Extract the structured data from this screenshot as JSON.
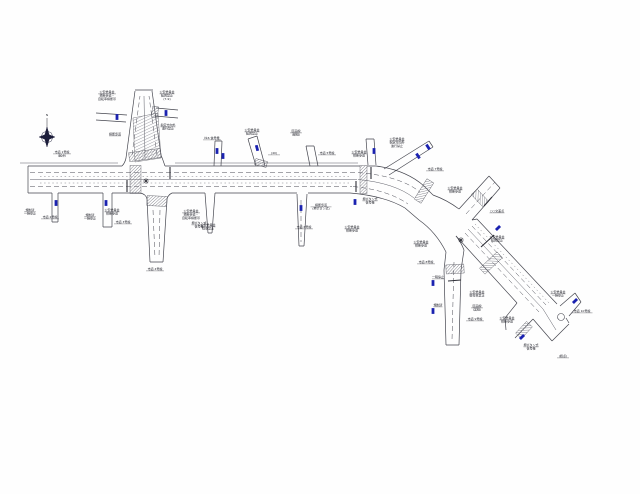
{
  "drawing": {
    "type": "road-traffic-regulation-plan",
    "colors": {
      "line": "#45464f",
      "sign_blue": "#1b22b0",
      "hatch": "#6f707a",
      "text": "#23242c",
      "background": "#fefefe"
    },
    "compass": {
      "x": 47,
      "y": 137,
      "label": "N"
    },
    "signals": [
      {
        "x": 146,
        "y": 181
      },
      {
        "x": 461,
        "y": 240
      }
    ],
    "signs": [
      {
        "x": 56,
        "y": 203,
        "a": 0
      },
      {
        "x": 106,
        "y": 203,
        "a": 0
      },
      {
        "x": 117,
        "y": 117,
        "a": 0
      },
      {
        "x": 166,
        "y": 113,
        "a": 0
      },
      {
        "x": 217,
        "y": 151,
        "a": 0
      },
      {
        "x": 223,
        "y": 156,
        "a": 0
      },
      {
        "x": 257,
        "y": 148,
        "a": -15
      },
      {
        "x": 301,
        "y": 208,
        "a": 0
      },
      {
        "x": 355,
        "y": 202,
        "a": 0
      },
      {
        "x": 374,
        "y": 151,
        "a": 0
      },
      {
        "x": 418,
        "y": 156,
        "a": -33
      },
      {
        "x": 428,
        "y": 147,
        "a": -33
      },
      {
        "x": 498,
        "y": 228,
        "a": 45
      },
      {
        "x": 433,
        "y": 283,
        "a": 0
      },
      {
        "x": 433,
        "y": 311,
        "a": 0
      },
      {
        "x": 522,
        "y": 337,
        "a": 45
      },
      {
        "x": 575,
        "y": 301,
        "a": 45
      }
    ],
    "labels": [
      {
        "x": 62,
        "y": 153,
        "lines": [
          "市道 1号線",
          "(起点)"
        ]
      },
      {
        "x": 107,
        "y": 93,
        "lines": [
          "公安委員会",
          "横断歩道・",
          "自転車横断帯"
        ]
      },
      {
        "x": 167,
        "y": 93,
        "lines": [
          "公安委員会",
          "転回禁止",
          "(7-9)"
        ]
      },
      {
        "x": 168,
        "y": 126,
        "lines": [
          "指定方向外",
          "進行禁止"
        ]
      },
      {
        "x": 115,
        "y": 135,
        "lines": [
          "横断歩道"
        ]
      },
      {
        "x": 30,
        "y": 211,
        "lines": [
          "規制済",
          "一時停止"
        ]
      },
      {
        "x": 50,
        "y": 218,
        "lines": [
          "市道 2号線"
        ]
      },
      {
        "x": 90,
        "y": 216,
        "lines": [
          "規制済",
          "一時停止"
        ]
      },
      {
        "x": 123,
        "y": 223,
        "lines": [
          "市道 3号線"
        ]
      },
      {
        "x": 112,
        "y": 211,
        "lines": [
          "公安委員会",
          "横断歩道"
        ]
      },
      {
        "x": 191,
        "y": 212,
        "lines": [
          "公安委員会",
          "横断歩道・",
          "自転車横断帯"
        ]
      },
      {
        "x": 199,
        "y": 224,
        "lines": [
          "押ボタン式",
          "信号機"
        ]
      },
      {
        "x": 155,
        "y": 270,
        "lines": [
          "市道 4号線"
        ]
      },
      {
        "x": 212,
        "y": 139,
        "lines": [
          "№6 信号機"
        ]
      },
      {
        "x": 252,
        "y": 131,
        "lines": [
          "公安委員会",
          "転回禁止"
        ]
      },
      {
        "x": 296,
        "y": 132,
        "lines": [
          "区画線",
          "(破線)"
        ]
      },
      {
        "x": 274,
        "y": 154,
        "lines": [
          "(40)"
        ]
      },
      {
        "x": 327,
        "y": 154,
        "lines": [
          "市道 5号線"
        ]
      },
      {
        "x": 208,
        "y": 226,
        "lines": [
          "公安委員会",
          "駐車禁止"
        ]
      },
      {
        "x": 321,
        "y": 206,
        "lines": [
          "横断歩道",
          "(押ボタン式)"
        ]
      },
      {
        "x": 304,
        "y": 228,
        "lines": [
          "市道 6号線"
        ]
      },
      {
        "x": 352,
        "y": 228,
        "lines": [
          "公安委員会",
          "横断歩道"
        ]
      },
      {
        "x": 359,
        "y": 153,
        "lines": [
          "公安委員会",
          "横断歩道"
        ]
      },
      {
        "x": 397,
        "y": 140,
        "lines": [
          "公安委員会",
          "指定方向外",
          "進行禁止"
        ]
      },
      {
        "x": 370,
        "y": 200,
        "lines": [
          "押ボタン式",
          "信号機"
        ]
      },
      {
        "x": 435,
        "y": 170,
        "lines": [
          "市道 7号線"
        ]
      },
      {
        "x": 455,
        "y": 189,
        "lines": [
          "公安委員会",
          "横断歩道"
        ]
      },
      {
        "x": 497,
        "y": 212,
        "lines": [
          "○○交差点"
        ]
      },
      {
        "x": 497,
        "y": 238,
        "lines": [
          "公安委員会",
          "転回禁止"
        ]
      },
      {
        "x": 421,
        "y": 243,
        "lines": [
          "公安委員会",
          "横断歩道"
        ]
      },
      {
        "x": 426,
        "y": 263,
        "lines": [
          "市道 8号線"
        ]
      },
      {
        "x": 438,
        "y": 278,
        "lines": [
          "一時停止"
        ]
      },
      {
        "x": 438,
        "y": 306,
        "lines": [
          "規制済"
        ]
      },
      {
        "x": 477,
        "y": 293,
        "lines": [
          "公安委員会",
          "駐停車禁止"
        ]
      },
      {
        "x": 477,
        "y": 307,
        "lines": [
          "区画線",
          "(実線)"
        ]
      },
      {
        "x": 475,
        "y": 320,
        "lines": [
          "市道 9号線"
        ]
      },
      {
        "x": 507,
        "y": 319,
        "lines": [
          "公安委員会",
          "横断歩道"
        ]
      },
      {
        "x": 558,
        "y": 293,
        "lines": [
          "公安委員会",
          "一時停止"
        ]
      },
      {
        "x": 582,
        "y": 312,
        "lines": [
          "市道 10号線"
        ]
      },
      {
        "x": 531,
        "y": 346,
        "lines": [
          "押ボタン式",
          "信号機"
        ]
      },
      {
        "x": 563,
        "y": 357,
        "lines": [
          "(終点)"
        ]
      }
    ]
  }
}
